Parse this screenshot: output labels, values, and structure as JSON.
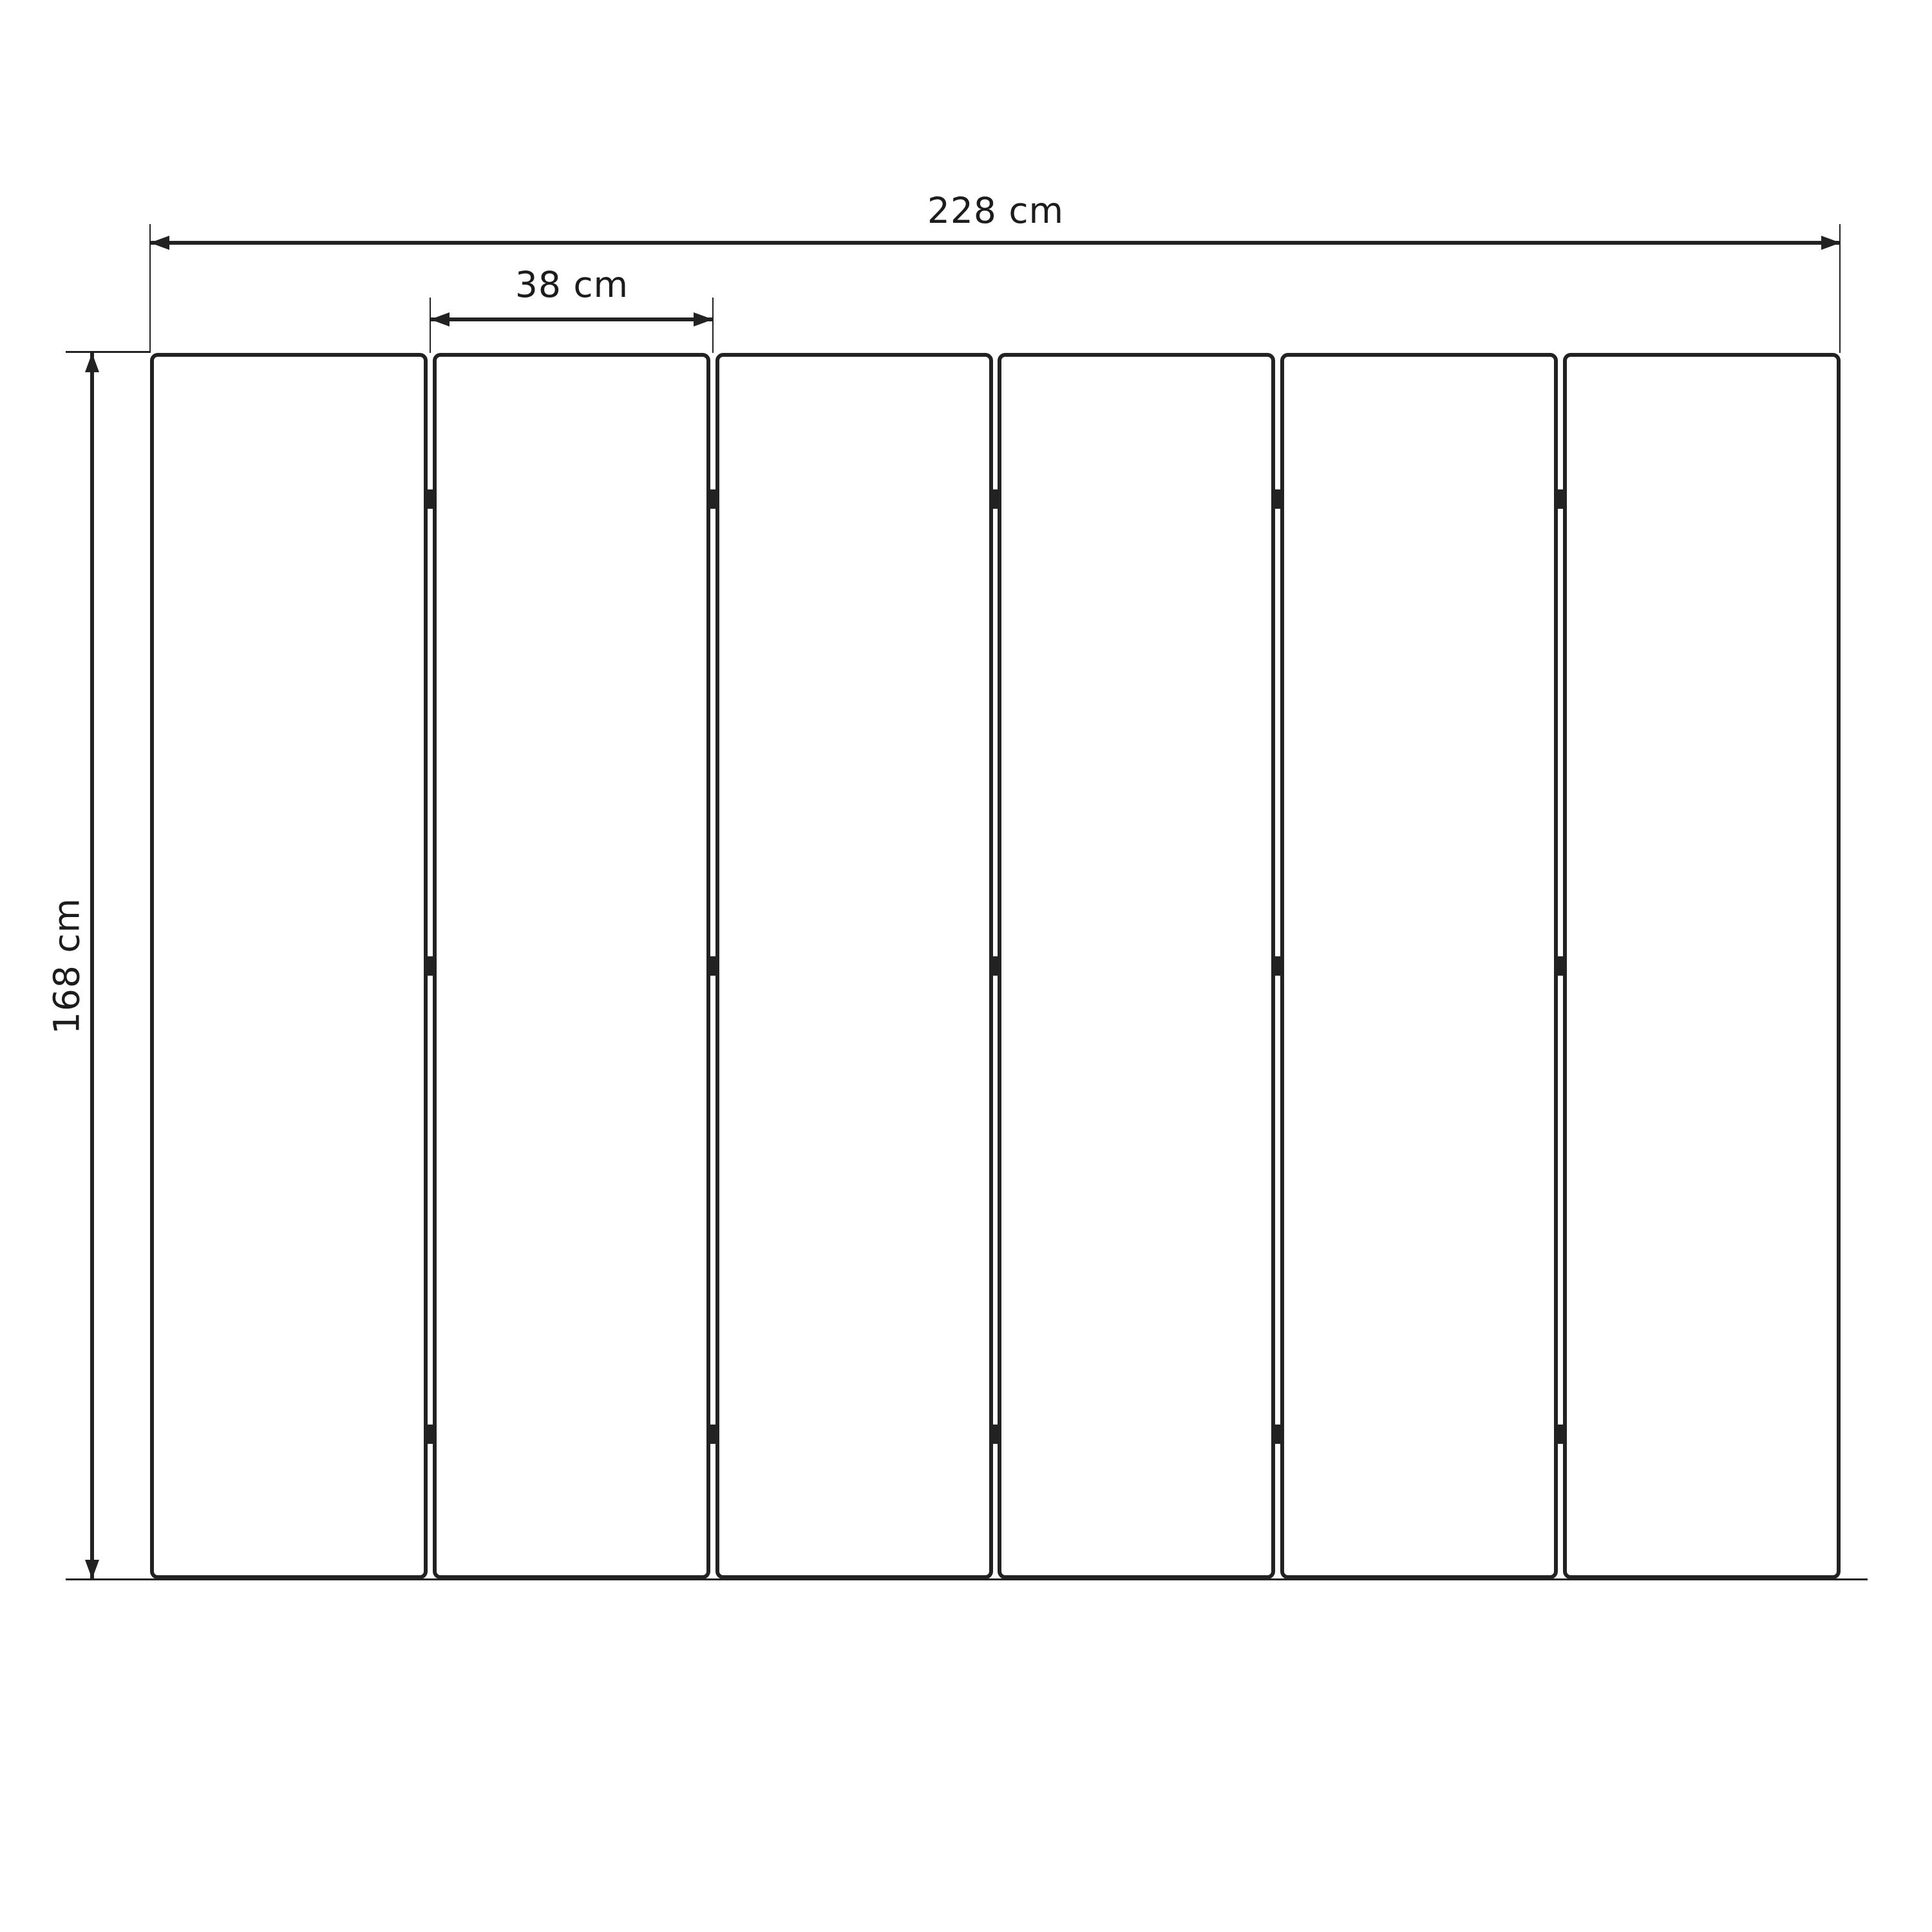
{
  "drawing": {
    "kind": "panel-layout-dimension-diagram",
    "panel_count": 6,
    "gap_count": 5,
    "hinge_rows_per_gap": 3,
    "dimensions": {
      "total_width": "228 cm",
      "panel_width": "38 cm",
      "height": "168 cm"
    },
    "colors": {
      "line": "#222222",
      "text": "#1c1c1c",
      "background": "#ffffff"
    }
  }
}
